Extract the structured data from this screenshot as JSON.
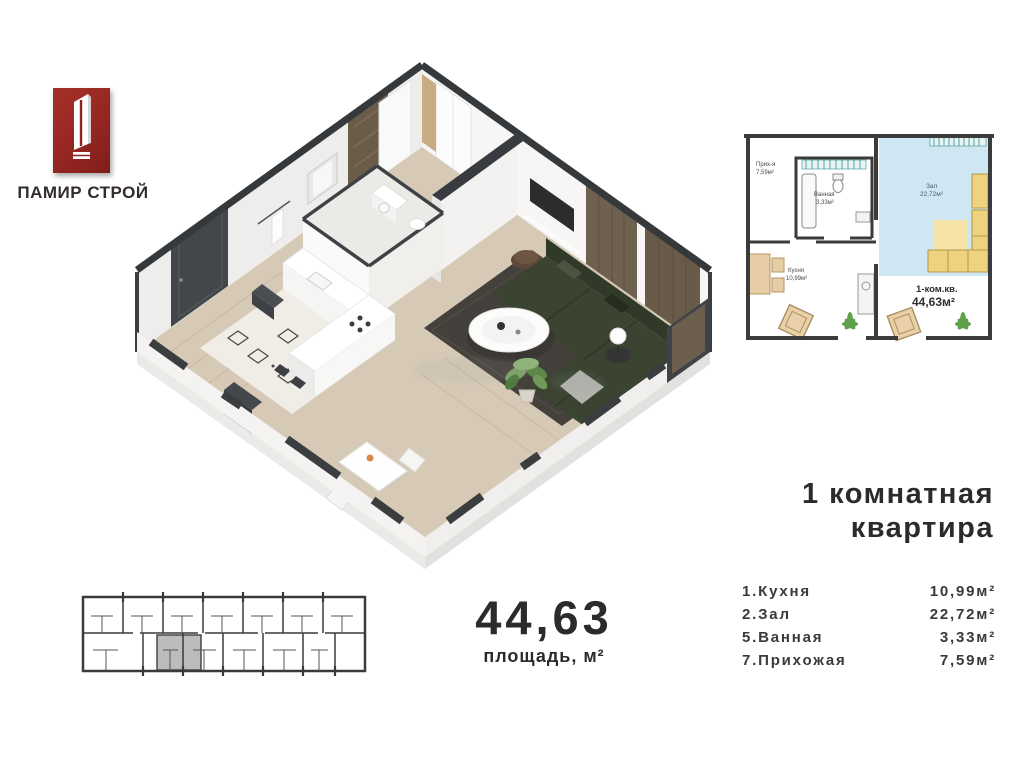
{
  "logo": {
    "company_name": "ПАМИР СТРОЙ",
    "icon": "tower-logo-icon",
    "brand_color": "#962622"
  },
  "title": {
    "line1": "1 комнатная",
    "line2": "квартира"
  },
  "area_summary": {
    "value": "44,63",
    "label": "площадь, м²"
  },
  "room_list": [
    {
      "label": "1.Кухня",
      "area": "10,99м²"
    },
    {
      "label": "2.Зал",
      "area": "22,72м²"
    },
    {
      "label": "5.Ванная",
      "area": "3,33м²"
    },
    {
      "label": "7.Прихожая",
      "area": "7,59м²"
    }
  ],
  "plan2d": {
    "rooms": {
      "hallway": {
        "name": "Прих-я",
        "area": "7,59м²"
      },
      "bathroom": {
        "name": "Ванная",
        "area": "3,33м²"
      },
      "living": {
        "name": "Зал",
        "area": "22,72м²"
      },
      "kitchen": {
        "name": "Кухня",
        "area": "10,99м²"
      }
    },
    "summary": {
      "type": "1-ком.кв.",
      "area": "44,63м²"
    }
  },
  "colors": {
    "wall_dark": "#383c40",
    "wood_floor": "#d6cab7",
    "sofa_green": "#3a4431",
    "panel_brown": "#6f6150",
    "plan_blue": "#cfe7f3",
    "plan_yellow": "#eed27f",
    "plant_green": "#5fa04a",
    "highlight_gray": "#bcbcbc"
  }
}
